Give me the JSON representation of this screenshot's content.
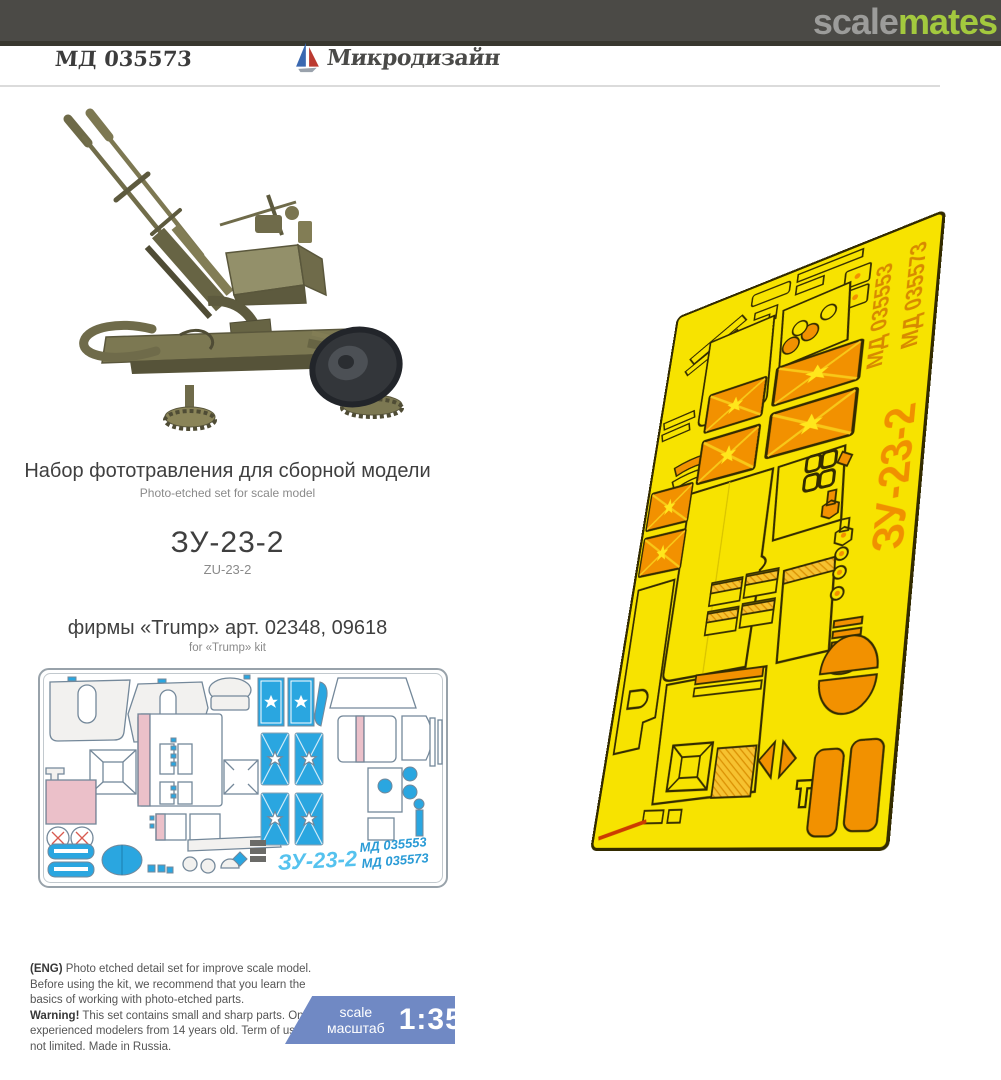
{
  "header": {
    "scalemates_scale": "scale",
    "scalemates_mates": "mates",
    "product_code": "МД 035573",
    "brand": "Микродизайн"
  },
  "info": {
    "title_ru": "Набор фототравления для сборной модели",
    "title_en": "Photo-etched set for scale model",
    "subject_ru": "ЗУ-23-2",
    "subject_en": "ZU-23-2",
    "kit_ru": "фирмы «Trump» арт. 02348, 09618",
    "kit_en": "for «Trump» kit"
  },
  "fret": {
    "subject": "ЗУ-23-2",
    "code_a": "МД 035553",
    "code_b": "МД 035573"
  },
  "footer": {
    "eng_bold": "(ENG)",
    "eng_text": " Photo etched detail set for improve scale model. Before using the kit, we recommend that you learn the basics of working with photo-etched parts.",
    "warning_bold": "Warning!",
    "warning_text": " This set contains small and sharp parts. Only for experienced modelers from 14 years old. Term of use is not limited. Made in Russia.",
    "scale_en": "scale",
    "scale_ru": "масштаб",
    "scale_value": "1:35"
  },
  "colors": {
    "topbar_gray": "#4b4a46",
    "mates_green": "#a3c93e",
    "fret_yellow": "#f7e300",
    "fret_orange": "#f29100",
    "diagram_blue": "#2aa6e0",
    "diagram_pink": "#e8aab6",
    "badge_blue": "#7089c4",
    "gun_olive": "#7c7852"
  }
}
